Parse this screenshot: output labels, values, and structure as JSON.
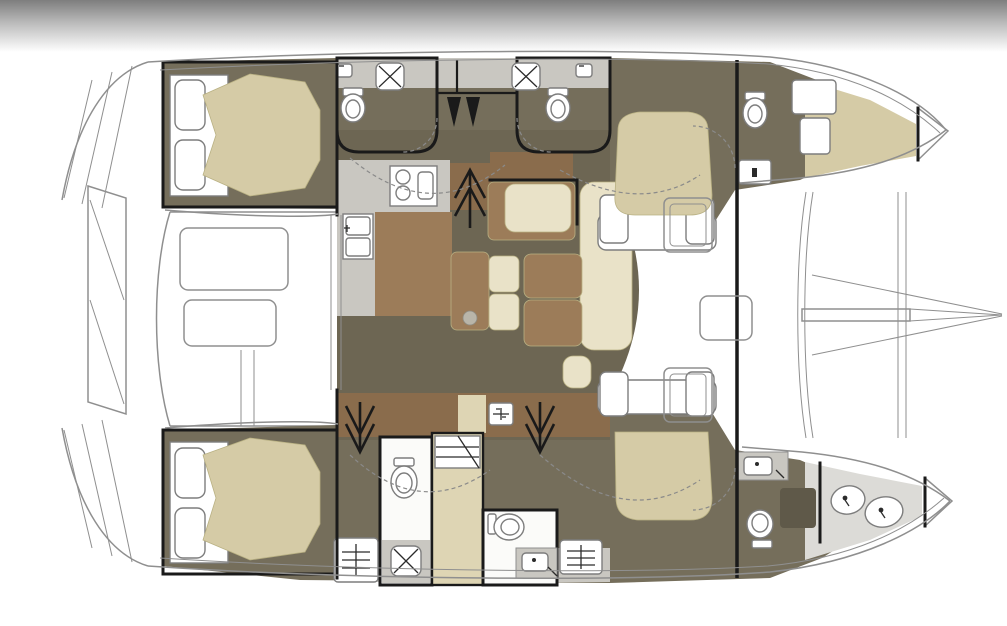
{
  "diagram": {
    "type": "yacht-floor-plan",
    "vessel": "sailing-catamaran",
    "view": "overhead-deck-and-accommodation-plan",
    "orientation": {
      "bow": "right",
      "stern": "left",
      "port_hull": "top",
      "starboard_hull": "bottom"
    },
    "counts": {
      "double_cabins": 4,
      "bathrooms": 4,
      "showers": 3,
      "toilets": 6,
      "forepeak_compartments": 2
    }
  },
  "colors": {
    "bg": "#ffffff",
    "band_dark": "#7e7e7e",
    "band_mid": "#bcbcbc",
    "olive": "#756e5b",
    "olive_salon": "#6d6653",
    "olive_dark": "#5f5949",
    "tan": "#d5cba6",
    "tan_pale": "#ded5b4",
    "cream": "#e9e2c8",
    "wood": "#9c7c59",
    "wood_dark": "#8a6c4c",
    "gray_light": "#c9c7c1",
    "gray_pale": "#dcdbd7",
    "wall": "#1a1a1a",
    "outline": "#8f8f8f",
    "fixture_stroke": "#7d7d7d"
  },
  "areas": {
    "cockpit": {
      "id": "aft-cockpit",
      "features": [
        "cockpit-table",
        "cockpit-bench",
        "transom-steps",
        "davit-platform"
      ]
    },
    "salon": {
      "id": "main-salon",
      "features": [
        "galley-counter",
        "stove",
        "double-sink",
        "dinette-sofa",
        "lounge-sofa",
        "coffee-table",
        "stools",
        "chaise",
        "pouf",
        "companionway-up",
        "mast-step"
      ]
    },
    "port_hull": {
      "id": "port-hull",
      "features": [
        "aft-double-cabin",
        "head-with-shower",
        "head-with-shower",
        "forward-island-bed-cabin",
        "forward-head",
        "forepeak-berth",
        "bow-locker"
      ]
    },
    "starboard_hull": {
      "id": "starboard-hull",
      "features": [
        "aft-double-cabin",
        "head-with-shower",
        "wardrobe",
        "forward-head",
        "forward-island-bed-cabin",
        "forepeak-basins",
        "bow-locker"
      ]
    },
    "foredeck": {
      "id": "foredeck",
      "features": [
        "forward-cockpit-seats",
        "forward-table",
        "crossbeam",
        "bowsprit",
        "trampoline-beams"
      ]
    }
  },
  "icons": [
    "toilet-icon",
    "shower-icon",
    "sink-icon",
    "faucet-icon",
    "stove-burners-icon",
    "stairs-up-arrow-icon",
    "stairs-down-arrow-icon",
    "mast-step-icon",
    "louver-locker-icon",
    "wardrobe-shelves-icon",
    "basin-icon"
  ]
}
